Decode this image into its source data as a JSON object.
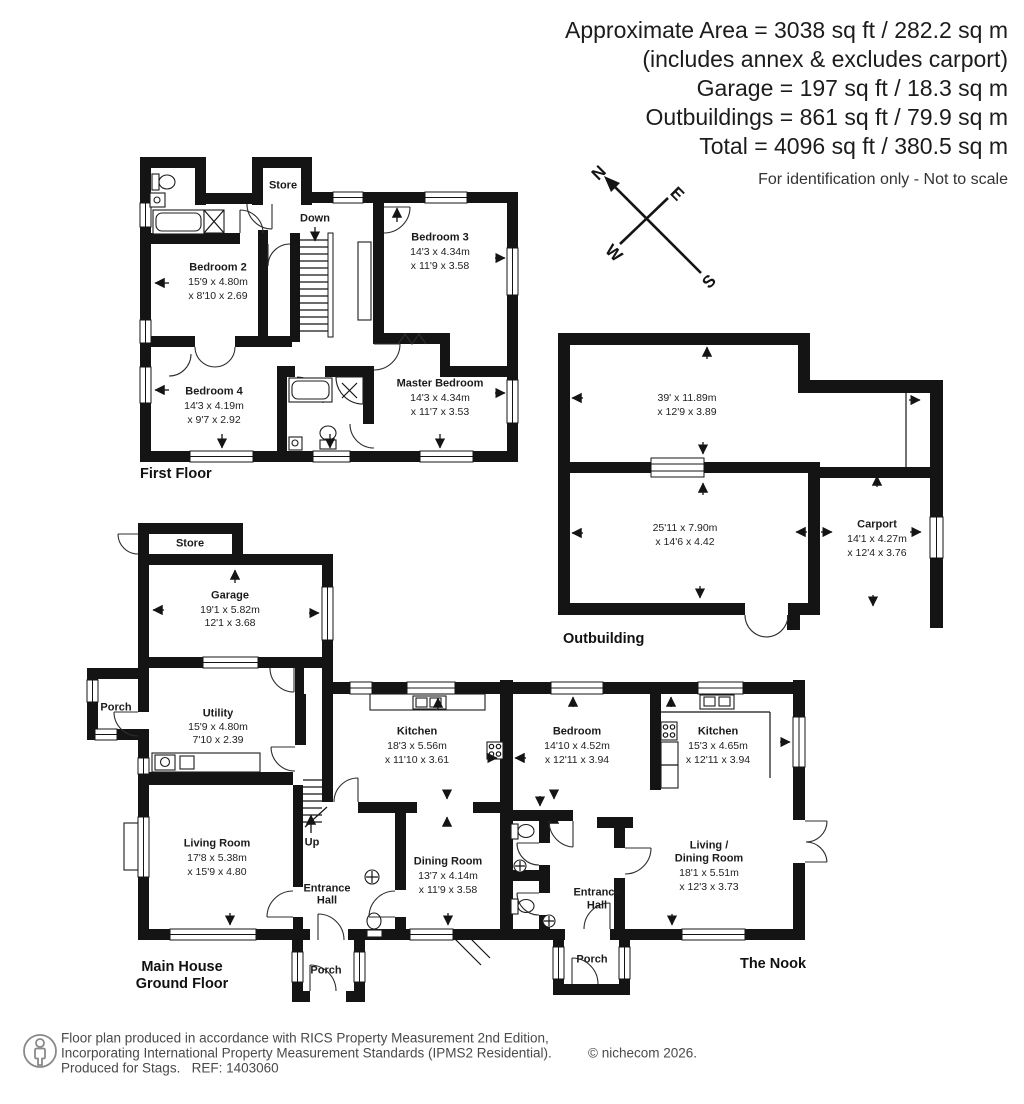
{
  "header": {
    "line1": "Approximate Area = 3038 sq ft / 282.2 sq m",
    "line2": "(includes annex & excludes carport)",
    "line3": "Garage = 197 sq ft / 18.3 sq m",
    "line4": "Outbuildings = 861 sq ft / 79.9 sq m",
    "line5": "Total = 4096 sq ft / 380.5 sq m",
    "note": "For identification only - Not to scale"
  },
  "compass": {
    "n": "N",
    "e": "E",
    "s": "S",
    "w": "W"
  },
  "first_floor": {
    "title": "First Floor",
    "store": "Store",
    "down": "Down",
    "bedroom2": {
      "name": "Bedroom 2",
      "d1": "15'9 x 4.80m",
      "d2": "x 8'10 x 2.69"
    },
    "bedroom3": {
      "name": "Bedroom 3",
      "d1": "14'3 x 4.34m",
      "d2": "x 11'9 x 3.58"
    },
    "bedroom4": {
      "name": "Bedroom 4",
      "d1": "14'3 x 4.19m",
      "d2": "x 9'7 x 2.92"
    },
    "master": {
      "name": "Master Bedroom",
      "d1": "14'3 x 4.34m",
      "d2": "x 11'7 x 3.53"
    }
  },
  "outbuilding": {
    "title": "Outbuilding",
    "room1": {
      "d1": "39' x 11.89m",
      "d2": "x 12'9 x 3.89"
    },
    "room2": {
      "d1": "25'11 x 7.90m",
      "d2": "x 14'6 x 4.42"
    },
    "carport": {
      "name": "Carport",
      "d1": "14'1 x 4.27m",
      "d2": "x 12'4 x 3.76"
    }
  },
  "ground_floor": {
    "title1": "Main House",
    "title2": "Ground Floor",
    "store": "Store",
    "porch_left": "Porch",
    "porch_front": "Porch",
    "up": "Up",
    "entrance1": "Entrance",
    "entrance2": "Hall",
    "garage": {
      "name": "Garage",
      "d1": "19'1 x 5.82m",
      "d2": "12'1 x 3.68"
    },
    "utility": {
      "name": "Utility",
      "d1": "15'9 x 4.80m",
      "d2": "7'10 x 2.39"
    },
    "kitchen": {
      "name": "Kitchen",
      "d1": "18'3 x 5.56m",
      "d2": "x 11'10 x 3.61"
    },
    "living": {
      "name": "Living Room",
      "d1": "17'8 x 5.38m",
      "d2": "x 15'9 x 4.80"
    },
    "dining": {
      "name": "Dining Room",
      "d1": "13'7 x 4.14m",
      "d2": "x 11'9 x 3.58"
    }
  },
  "nook": {
    "title": "The Nook",
    "entrance1": "Entrance",
    "entrance2": "Hall",
    "porch": "Porch",
    "bedroom": {
      "name": "Bedroom",
      "d1": "14'10 x 4.52m",
      "d2": "x 12'11 x 3.94"
    },
    "kitchen": {
      "name": "Kitchen",
      "d1": "15'3 x 4.65m",
      "d2": "x 12'11 x 3.94"
    },
    "living": {
      "name1": "Living /",
      "name2": "Dining Room",
      "d1": "18'1 x 5.51m",
      "d2": "x 12'3 x 3.73"
    }
  },
  "footer": {
    "line1": "Floor plan produced in accordance with RICS Property Measurement 2nd Edition,",
    "line2": "Incorporating International Property Measurement Standards (IPMS2 Residential).",
    "line3": "Produced for Stags.   REF: 1403060",
    "copyright": "© nichecom 2026."
  }
}
